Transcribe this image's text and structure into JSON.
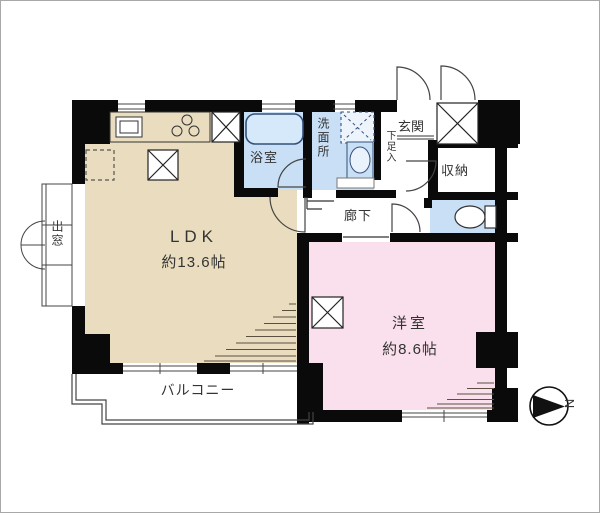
{
  "rooms": {
    "ldk": {
      "name": "LDK",
      "size": "約13.6帖"
    },
    "western": {
      "name": "洋室",
      "size": "約8.6帖"
    },
    "bath": {
      "name": "浴室"
    },
    "washroom": {
      "name": "洗面所"
    },
    "entrance": {
      "name": "玄関"
    },
    "storage": {
      "name": "収納"
    },
    "hallway": {
      "name": "廊下"
    },
    "balcony": {
      "name": "バルコニー"
    },
    "bay_window": {
      "name": "出窓"
    },
    "shoe_cabinet": {
      "name": "下足入"
    }
  },
  "compass": {
    "north_label": "N"
  },
  "colors": {
    "ldk": "#EADDBF",
    "western": "#FAE0EC",
    "wet_area": "#C8DFF5",
    "wall": "#0a0a0a",
    "line": "#444444"
  }
}
